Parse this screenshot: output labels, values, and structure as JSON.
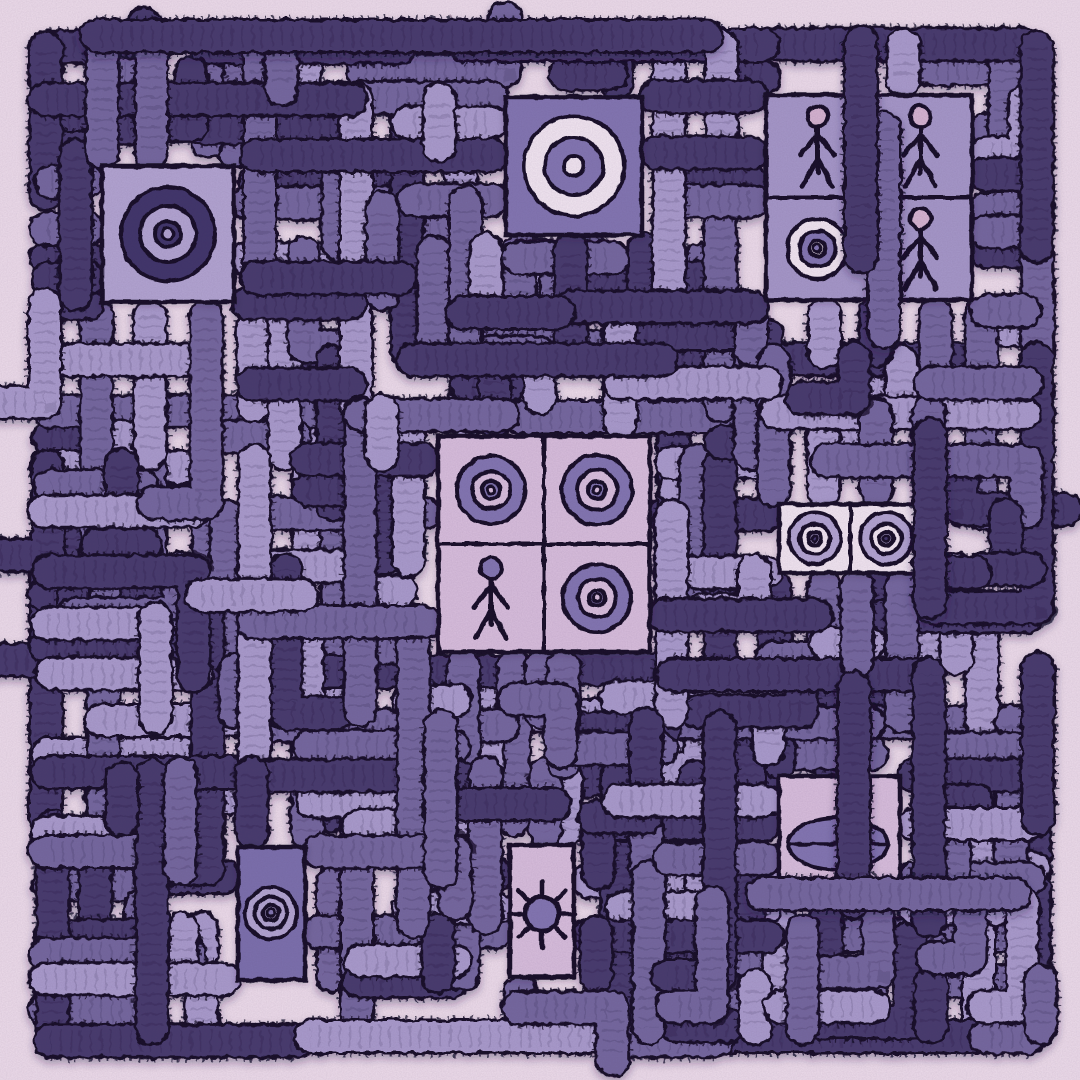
{
  "palette": {
    "background": "#eeddeb",
    "outline": "#150e26",
    "shadow": "#2a1c47",
    "pipe_dark": "#463a6d",
    "pipe_mid": "#75689f",
    "pipe_light": "#aa9ccd",
    "panel_lavender": "#b3a5d2",
    "panel_lavender2": "#a698c9",
    "panel_mid": "#8376b2",
    "panel_mid_dark": "#7b6fad",
    "cell_pink": "#d9bfdd",
    "cream": "#f3e7f2",
    "head_pink": "#d6b4d1",
    "target_dark": "#41346a",
    "none": "none"
  },
  "maze": {
    "seed": 1337,
    "margin": 48,
    "cell": 52,
    "lines": 20,
    "pipe_width": 30,
    "skip_prob": 0.13,
    "elbow_prob": 0.2,
    "shade_weights": {
      "dark": 0.37,
      "mid": 0.34,
      "light": 0.29
    }
  },
  "feature_pipes": [
    {
      "shade": "dark",
      "pts": [
        [
          96,
          36
        ],
        [
          706,
          36
        ]
      ]
    },
    {
      "shade": "mid",
      "pts": [
        [
          884,
          128
        ],
        [
          884,
          332
        ]
      ]
    },
    {
      "shade": "dark",
      "pts": [
        [
          861,
          42
        ],
        [
          861,
          256
        ]
      ]
    },
    {
      "shade": "dark",
      "pts": [
        [
          930,
          434
        ],
        [
          930,
          602
        ]
      ]
    },
    {
      "shade": "dark",
      "pts": [
        [
          854,
          688
        ],
        [
          854,
          902
        ]
      ]
    },
    {
      "shade": "mid",
      "pts": [
        [
          762,
          894
        ],
        [
          1014,
          894
        ]
      ]
    }
  ],
  "panels": [
    {
      "name": "top-left-target-panel",
      "type": "target",
      "rect": [
        102,
        166,
        132,
        136
      ],
      "fill": "panel_lavender",
      "center": [
        168,
        234
      ],
      "rings": [
        {
          "r": 47,
          "fill": "target_dark"
        },
        {
          "r": 28,
          "fill": "panel_lavender"
        },
        {
          "r": 13,
          "fill": "target_dark"
        },
        {
          "r": 6,
          "fill": "panel_lavender"
        }
      ]
    },
    {
      "name": "top-center-target-panel",
      "type": "target",
      "rect": [
        506,
        97,
        136,
        138
      ],
      "fill": "panel_mid",
      "center": [
        574,
        166
      ],
      "rings": [
        {
          "r": 50,
          "fill": "cream"
        },
        {
          "r": 29,
          "fill": "panel_mid"
        },
        {
          "r": 10,
          "fill": "cream"
        }
      ]
    },
    {
      "name": "top-right-figure-grid-panel",
      "type": "grid",
      "rect": [
        766,
        95,
        206,
        205
      ],
      "fill": "panel_lavender2",
      "rows": 2,
      "cols": 2,
      "items": [
        {
          "type": "stick",
          "head": "head_pink"
        },
        {
          "type": "stick",
          "head": "head_pink"
        },
        {
          "type": "target",
          "rings": [
            {
              "r": 30,
              "fill": "cream"
            },
            {
              "r": 18,
              "fill": "panel_mid"
            },
            {
              "r": 8,
              "fill": "cream"
            },
            {
              "r": 4,
              "fill": "panel_mid"
            }
          ]
        },
        {
          "type": "stick",
          "head": "head_pink"
        }
      ]
    },
    {
      "name": "center-symbol-grid-panel",
      "type": "grid",
      "rect": [
        438,
        436,
        212,
        216
      ],
      "fill": "cell_pink",
      "rows": 2,
      "cols": 2,
      "items": [
        {
          "type": "target",
          "rings": [
            {
              "r": 34,
              "fill": "panel_mid"
            },
            {
              "r": 19,
              "fill": "cell_pink"
            },
            {
              "r": 9,
              "fill": "panel_mid"
            },
            {
              "r": 4,
              "fill": "cell_pink"
            }
          ]
        },
        {
          "type": "target",
          "rings": [
            {
              "r": 35,
              "fill": "panel_mid"
            },
            {
              "r": 20,
              "fill": "cell_pink"
            },
            {
              "r": 9,
              "fill": "panel_mid"
            },
            {
              "r": 4,
              "fill": "cell_pink"
            }
          ]
        },
        {
          "type": "stick",
          "head": "panel_mid"
        },
        {
          "type": "target",
          "rings": [
            {
              "r": 34,
              "fill": "panel_mid"
            },
            {
              "r": 19,
              "fill": "cell_pink"
            },
            {
              "r": 8,
              "fill": "panel_mid"
            },
            {
              "r": 4,
              "fill": "cell_pink"
            }
          ]
        }
      ]
    },
    {
      "name": "right-eye-strip-panel",
      "type": "grid",
      "rect": [
        779,
        504,
        143,
        69
      ],
      "fill": "cream",
      "rows": 1,
      "cols": 2,
      "items": [
        {
          "type": "target",
          "rings": [
            {
              "r": 26,
              "fill": "panel_lavender"
            },
            {
              "r": 15,
              "fill": "cream"
            },
            {
              "r": 7,
              "fill": "panel_lavender"
            },
            {
              "r": 3,
              "fill": "target_dark"
            }
          ]
        },
        {
          "type": "target",
          "rings": [
            {
              "r": 26,
              "fill": "panel_lavender"
            },
            {
              "r": 15,
              "fill": "cream"
            },
            {
              "r": 7,
              "fill": "panel_lavender"
            },
            {
              "r": 3,
              "fill": "target_dark"
            }
          ]
        }
      ]
    },
    {
      "name": "bottom-left-target-panel",
      "type": "target",
      "rect": [
        238,
        847,
        67,
        133
      ],
      "fill": "panel_mid_dark",
      "center": [
        271,
        913
      ],
      "rings": [
        {
          "r": 26,
          "fill": "panel_lavender"
        },
        {
          "r": 16,
          "fill": "none"
        },
        {
          "r": 8,
          "fill": "panel_lavender"
        },
        {
          "r": 4,
          "fill": "panel_mid"
        }
      ]
    },
    {
      "name": "bottom-center-sun-panel",
      "type": "sun",
      "rect": [
        510,
        845,
        64,
        132
      ],
      "fill": "cell_pink",
      "center": [
        542,
        914
      ],
      "radius": 17,
      "ray_len": 13,
      "rays": 8
    },
    {
      "name": "bottom-right-ellipse-panel",
      "type": "ellipse",
      "rect": [
        779,
        776,
        121,
        130
      ],
      "fill": "cell_pink",
      "center": [
        838,
        844
      ],
      "rx": 50,
      "ry": 26
    }
  ]
}
